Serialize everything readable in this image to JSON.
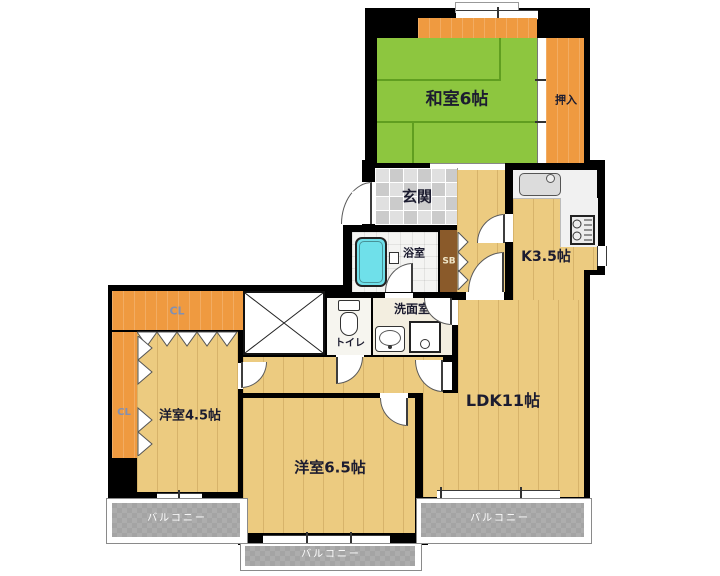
{
  "plan_title": "apartment-floor-plan",
  "colors": {
    "wall": "#000000",
    "tatami": "#8dc63f",
    "tatami-line": "#609e20",
    "wood": "#eccb80",
    "closet-orange": "#ef9a40",
    "shoebox-brown": "#8a5a2a",
    "tile-gray": "#d8d8d8",
    "bath-tub": "#6fe0ea",
    "balcony-gray": "#a4a4a4",
    "label-dark": "#1c1c30",
    "label-light": "#ffffff",
    "closet-label": "#8290b2",
    "shoebox-label": "#f0e6c8"
  },
  "rooms": {
    "washitsu": "和室6帖",
    "oshiire": "押入",
    "genkan": "玄関",
    "bathroom": "浴室",
    "shoebox": "SB",
    "kitchen": "K3.5帖",
    "washroom": "洗面室",
    "toilet": "トイレ",
    "closet_top": "CL",
    "closet_left": "CL",
    "bedroom_small": "洋室4.5帖",
    "bedroom_mid": "洋室6.5帖",
    "ldk": "LDK11帖",
    "balcony_left": "バルコニー",
    "balcony_center": "バルコニー",
    "balcony_right": "バルコニー"
  }
}
